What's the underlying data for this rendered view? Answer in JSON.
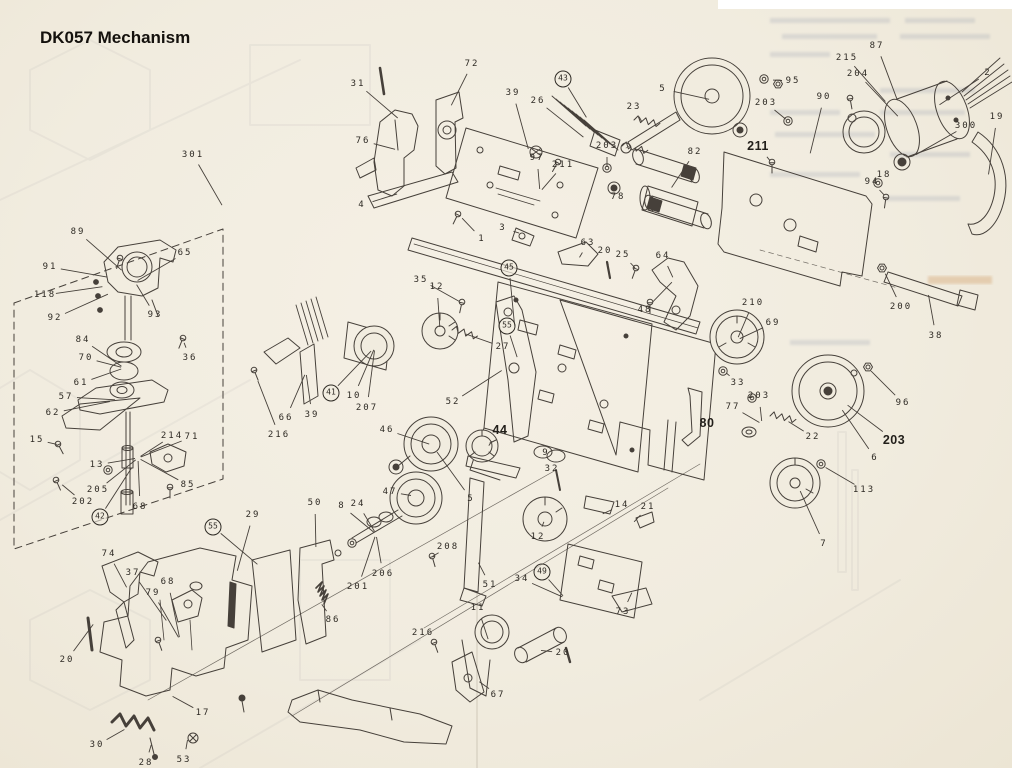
{
  "page": {
    "title": "DK057 Mechanism",
    "paper_color": "#f1ecdf",
    "ink_color": "#46403a",
    "ghost_note": "illegible mirrored print bleed-through from reverse side of page"
  },
  "diagram": {
    "name": "dk057-exploded-parts-diagram",
    "labels": [
      {
        "t": "301",
        "x": 193,
        "y": 155,
        "g": "box"
      },
      {
        "t": "89",
        "x": 78,
        "y": 232,
        "g": "head"
      },
      {
        "t": "65",
        "x": 185,
        "y": 253,
        "g": "head"
      },
      {
        "t": "91",
        "x": 50,
        "y": 267,
        "g": "head"
      },
      {
        "t": "118",
        "x": 45,
        "y": 295,
        "g": "head"
      },
      {
        "t": "92",
        "x": 55,
        "y": 318,
        "g": "head"
      },
      {
        "t": "93",
        "x": 155,
        "y": 315,
        "g": "head"
      },
      {
        "t": "36",
        "x": 190,
        "y": 358,
        "g": "scr36"
      },
      {
        "t": "84",
        "x": 83,
        "y": 340,
        "g": "headmid"
      },
      {
        "t": "70",
        "x": 86,
        "y": 358,
        "g": "headmid"
      },
      {
        "t": "61",
        "x": 81,
        "y": 383,
        "g": "headmid"
      },
      {
        "t": "57",
        "x": 66,
        "y": 397,
        "g": "plate57"
      },
      {
        "t": "62",
        "x": 53,
        "y": 413,
        "g": "plate57"
      },
      {
        "t": "15",
        "x": 37,
        "y": 440,
        "g": "scr15"
      },
      {
        "t": "13",
        "x": 97,
        "y": 465,
        "g": "headlow"
      },
      {
        "t": "205",
        "x": 98,
        "y": 490,
        "g": "headlow"
      },
      {
        "t": "202",
        "x": 83,
        "y": 502,
        "g": "scr202"
      },
      {
        "t": "214",
        "x": 172,
        "y": 436,
        "g": "headlow"
      },
      {
        "t": "71",
        "x": 192,
        "y": 437,
        "g": "headlow"
      },
      {
        "t": "85",
        "x": 188,
        "y": 485,
        "g": "headlow"
      },
      {
        "t": "68",
        "x": 140,
        "y": 507,
        "g": "headlow"
      },
      {
        "t": "42",
        "x": 100,
        "y": 517,
        "g": "headlow",
        "c": 1
      },
      {
        "t": "55",
        "x": 213,
        "y": 527,
        "g": "combs",
        "c": 1
      },
      {
        "t": "31",
        "x": 358,
        "y": 84,
        "g": "topmid"
      },
      {
        "t": "72",
        "x": 472,
        "y": 64,
        "g": "br72"
      },
      {
        "t": "76",
        "x": 363,
        "y": 141,
        "g": "br76"
      },
      {
        "t": "39",
        "x": 513,
        "y": 93,
        "g": "pcb"
      },
      {
        "t": "26",
        "x": 538,
        "y": 101,
        "g": "c26"
      },
      {
        "t": "43",
        "x": 563,
        "y": 79,
        "g": "rib",
        "c": 1
      },
      {
        "t": "97",
        "x": 537,
        "y": 158,
        "g": "pcb"
      },
      {
        "t": "211",
        "x": 563,
        "y": 165,
        "g": "pcb"
      },
      {
        "t": "203",
        "x": 607,
        "y": 146,
        "g": "w203a"
      },
      {
        "t": "78",
        "x": 618,
        "y": 197,
        "g": "r78"
      },
      {
        "t": "4",
        "x": 362,
        "y": 205,
        "g": "rod4"
      },
      {
        "t": "1",
        "x": 482,
        "y": 239,
        "g": "scr1"
      },
      {
        "t": "3",
        "x": 503,
        "y": 228,
        "g": "p3"
      },
      {
        "t": "63",
        "x": 588,
        "y": 243,
        "g": "l63"
      },
      {
        "t": "20",
        "x": 605,
        "y": 251,
        "g": "pin20"
      },
      {
        "t": "25",
        "x": 623,
        "y": 255,
        "g": "s25"
      },
      {
        "t": "64",
        "x": 663,
        "y": 256,
        "g": "l64"
      },
      {
        "t": "48",
        "x": 645,
        "y": 310,
        "g": "l64"
      },
      {
        "t": "5",
        "x": 663,
        "y": 89,
        "g": "fly"
      },
      {
        "t": "95",
        "x": 793,
        "y": 81,
        "g": "w95"
      },
      {
        "t": "23",
        "x": 634,
        "y": 107,
        "g": "sp23"
      },
      {
        "t": "203",
        "x": 766,
        "y": 103,
        "g": "w203b"
      },
      {
        "t": "90",
        "x": 824,
        "y": 97,
        "g": "p90"
      },
      {
        "t": "215",
        "x": 847,
        "y": 58,
        "g": "mot"
      },
      {
        "t": "87",
        "x": 877,
        "y": 46,
        "g": "mot"
      },
      {
        "t": "204",
        "x": 858,
        "y": 74,
        "g": "mot"
      },
      {
        "t": "2",
        "x": 988,
        "y": 73,
        "g": "mot"
      },
      {
        "t": "300",
        "x": 966,
        "y": 126,
        "g": "p300"
      },
      {
        "t": "19",
        "x": 997,
        "y": 117,
        "g": "pinch"
      },
      {
        "t": "18",
        "x": 884,
        "y": 175,
        "g": "w18"
      },
      {
        "t": "94",
        "x": 872,
        "y": 182,
        "g": "s94"
      },
      {
        "t": "82",
        "x": 695,
        "y": 152,
        "g": "r82"
      },
      {
        "t": "211",
        "x": 758,
        "y": 146,
        "g": "s211",
        "b": 1
      },
      {
        "t": "38",
        "x": 936,
        "y": 336,
        "g": "rod38"
      },
      {
        "t": "200",
        "x": 901,
        "y": 307,
        "g": "n200"
      },
      {
        "t": "210",
        "x": 753,
        "y": 303,
        "g": "reelA"
      },
      {
        "t": "69",
        "x": 773,
        "y": 323,
        "g": "reelA"
      },
      {
        "t": "33",
        "x": 738,
        "y": 383,
        "g": "w33"
      },
      {
        "t": "77",
        "x": 733,
        "y": 407,
        "g": "reelmid"
      },
      {
        "t": "203",
        "x": 759,
        "y": 396,
        "g": "reelmid"
      },
      {
        "t": "22",
        "x": 813,
        "y": 437,
        "g": "sp22"
      },
      {
        "t": "80",
        "x": 707,
        "y": 423,
        "g": "a80",
        "b": 1
      },
      {
        "t": "96",
        "x": 903,
        "y": 403,
        "g": "n96"
      },
      {
        "t": "203",
        "x": 894,
        "y": 440,
        "g": "reelB",
        "b": 1
      },
      {
        "t": "6",
        "x": 875,
        "y": 458,
        "g": "reelB"
      },
      {
        "t": "113",
        "x": 864,
        "y": 490,
        "g": "w113"
      },
      {
        "t": "7",
        "x": 824,
        "y": 544,
        "g": "reel7"
      },
      {
        "t": "35",
        "x": 421,
        "y": 280,
        "g": "s35"
      },
      {
        "t": "12",
        "x": 437,
        "y": 287,
        "g": "g12a"
      },
      {
        "t": "45",
        "x": 509,
        "y": 268,
        "g": "lev52",
        "c": 1
      },
      {
        "t": "55",
        "x": 507,
        "y": 326,
        "g": "lev52",
        "c": 1
      },
      {
        "t": "27",
        "x": 503,
        "y": 347,
        "g": "sp27"
      },
      {
        "t": "41",
        "x": 331,
        "y": 393,
        "g": "m10",
        "c": 1
      },
      {
        "t": "10",
        "x": 354,
        "y": 396,
        "g": "m10"
      },
      {
        "t": "207",
        "x": 367,
        "y": 408,
        "g": "m10"
      },
      {
        "t": "66",
        "x": 286,
        "y": 418,
        "g": "combL"
      },
      {
        "t": "39",
        "x": 312,
        "y": 415,
        "g": "combL"
      },
      {
        "t": "216",
        "x": 279,
        "y": 435,
        "g": "s216a"
      },
      {
        "t": "52",
        "x": 453,
        "y": 402,
        "g": "lev52"
      },
      {
        "t": "46",
        "x": 387,
        "y": 430,
        "g": "p46"
      },
      {
        "t": "44",
        "x": 500,
        "y": 430,
        "g": "g44",
        "b": 1
      },
      {
        "t": "9",
        "x": 546,
        "y": 453,
        "g": "r9"
      },
      {
        "t": "32",
        "x": 552,
        "y": 469,
        "g": "pin32"
      },
      {
        "t": "5",
        "x": 471,
        "y": 499,
        "g": "p46"
      },
      {
        "t": "47",
        "x": 390,
        "y": 492,
        "g": "p47f"
      },
      {
        "t": "8",
        "x": 342,
        "y": 506,
        "g": "p47p"
      },
      {
        "t": "24",
        "x": 358,
        "y": 504,
        "g": "p47p"
      },
      {
        "t": "206",
        "x": 383,
        "y": 574,
        "g": "p47p"
      },
      {
        "t": "201",
        "x": 358,
        "y": 587,
        "g": "p47p"
      },
      {
        "t": "86",
        "x": 333,
        "y": 620,
        "g": "sp86"
      },
      {
        "t": "29",
        "x": 253,
        "y": 515,
        "g": "c29"
      },
      {
        "t": "50",
        "x": 315,
        "y": 503,
        "g": "c50"
      },
      {
        "t": "208",
        "x": 448,
        "y": 547,
        "g": "s208"
      },
      {
        "t": "12",
        "x": 538,
        "y": 537,
        "g": "g12"
      },
      {
        "t": "14",
        "x": 622,
        "y": 505,
        "g": "lev14"
      },
      {
        "t": "21",
        "x": 648,
        "y": 507,
        "g": "c21"
      },
      {
        "t": "51",
        "x": 490,
        "y": 585,
        "g": "b51"
      },
      {
        "t": "34",
        "x": 522,
        "y": 579,
        "g": "br34"
      },
      {
        "t": "49",
        "x": 542,
        "y": 572,
        "g": "br34",
        "c": 1
      },
      {
        "t": "73",
        "x": 623,
        "y": 612,
        "g": "b73"
      },
      {
        "t": "11",
        "x": 478,
        "y": 608,
        "g": "m11"
      },
      {
        "t": "216",
        "x": 423,
        "y": 633,
        "g": "s216b"
      },
      {
        "t": "20",
        "x": 563,
        "y": 653,
        "g": "cyl20"
      },
      {
        "t": "67",
        "x": 498,
        "y": 695,
        "g": "a67"
      },
      {
        "t": "74",
        "x": 109,
        "y": 554,
        "g": "bl74"
      },
      {
        "t": "37",
        "x": 133,
        "y": 573,
        "g": "bl"
      },
      {
        "t": "79",
        "x": 153,
        "y": 593,
        "g": "bl"
      },
      {
        "t": "68",
        "x": 168,
        "y": 582,
        "g": "bl"
      },
      {
        "t": "20",
        "x": 67,
        "y": 660,
        "g": "rod20"
      },
      {
        "t": "17",
        "x": 203,
        "y": 713,
        "g": "br17"
      },
      {
        "t": "30",
        "x": 97,
        "y": 745,
        "g": "sp30"
      },
      {
        "t": "28",
        "x": 146,
        "y": 763,
        "g": "s28"
      },
      {
        "t": "53",
        "x": 184,
        "y": 760,
        "g": "p53"
      }
    ],
    "leader_targets": {
      "box": [
        234,
        226
      ],
      "head": [
        135,
        282
      ],
      "scr36": [
        183,
        340
      ],
      "headmid": [
        124,
        368
      ],
      "plate57": [
        118,
        400
      ],
      "scr15": [
        60,
        445
      ],
      "headlow": [
        138,
        458
      ],
      "scr202": [
        60,
        483
      ],
      "combs": [
        300,
        600
      ],
      "topmid": [
        400,
        120
      ],
      "br72": [
        450,
        108
      ],
      "br76": [
        398,
        150
      ],
      "pcb": [
        540,
        192
      ],
      "c26": [
        660,
        198
      ],
      "rib": [
        588,
        120
      ],
      "w203a": [
        607,
        170
      ],
      "r78": [
        614,
        188
      ],
      "rod4": [
        400,
        193
      ],
      "scr1": [
        460,
        216
      ],
      "p3": [
        522,
        234
      ],
      "l63": [
        578,
        260
      ],
      "pin20": [
        609,
        268
      ],
      "s25": [
        637,
        270
      ],
      "l64": [
        674,
        280
      ],
      "fly": [
        712,
        100
      ],
      "w95": [
        770,
        80
      ],
      "sp23": [
        643,
        124
      ],
      "w203b": [
        788,
        121
      ],
      "p90": [
        795,
        215
      ],
      "mot": [
        907,
        126
      ],
      "p300": [
        910,
        158
      ],
      "pinch": [
        988,
        178
      ],
      "w18": [
        878,
        184
      ],
      "s94": [
        886,
        197
      ],
      "r82": [
        670,
        190
      ],
      "s211": [
        772,
        163
      ],
      "rod38": [
        928,
        292
      ],
      "n200": [
        884,
        271
      ],
      "reelA": [
        737,
        340
      ],
      "w33": [
        724,
        371
      ],
      "reelmid": [
        762,
        424
      ],
      "sp22": [
        786,
        420
      ],
      "a80": [
        694,
        420
      ],
      "n96": [
        869,
        369
      ],
      "reelB": [
        830,
        392
      ],
      "reel7": [
        797,
        484
      ],
      "w113": [
        823,
        466
      ],
      "s35": [
        462,
        303
      ],
      "g12a": [
        440,
        330
      ],
      "lev52": [
        518,
        360
      ],
      "sp27": [
        463,
        333
      ],
      "m10": [
        375,
        347
      ],
      "combL": [
        306,
        372
      ],
      "s216a": [
        254,
        371
      ],
      "p46": [
        432,
        445
      ],
      "g44": [
        487,
        448
      ],
      "r9": [
        549,
        455
      ],
      "pin32": [
        557,
        478
      ],
      "p47f": [
        414,
        496
      ],
      "p47p": [
        376,
        534
      ],
      "sp86": [
        320,
        602
      ],
      "c29": [
        233,
        586
      ],
      "c50": [
        316,
        550
      ],
      "s208": [
        430,
        558
      ],
      "g12": [
        545,
        519
      ],
      "lev14": [
        600,
        515
      ],
      "c21": [
        632,
        524
      ],
      "b51": [
        477,
        560
      ],
      "br34": [
        565,
        598
      ],
      "b73": [
        633,
        590
      ],
      "m11": [
        489,
        642
      ],
      "s216b": [
        435,
        642
      ],
      "cyl20": [
        538,
        650
      ],
      "a67": [
        477,
        680
      ],
      "bl74": [
        128,
        590
      ],
      "bl": [
        180,
        640
      ],
      "rod20": [
        95,
        622
      ],
      "br17": [
        170,
        695
      ],
      "sp30": [
        127,
        728
      ],
      "s28": [
        152,
        742
      ],
      "p53": [
        188,
        737
      ]
    }
  }
}
